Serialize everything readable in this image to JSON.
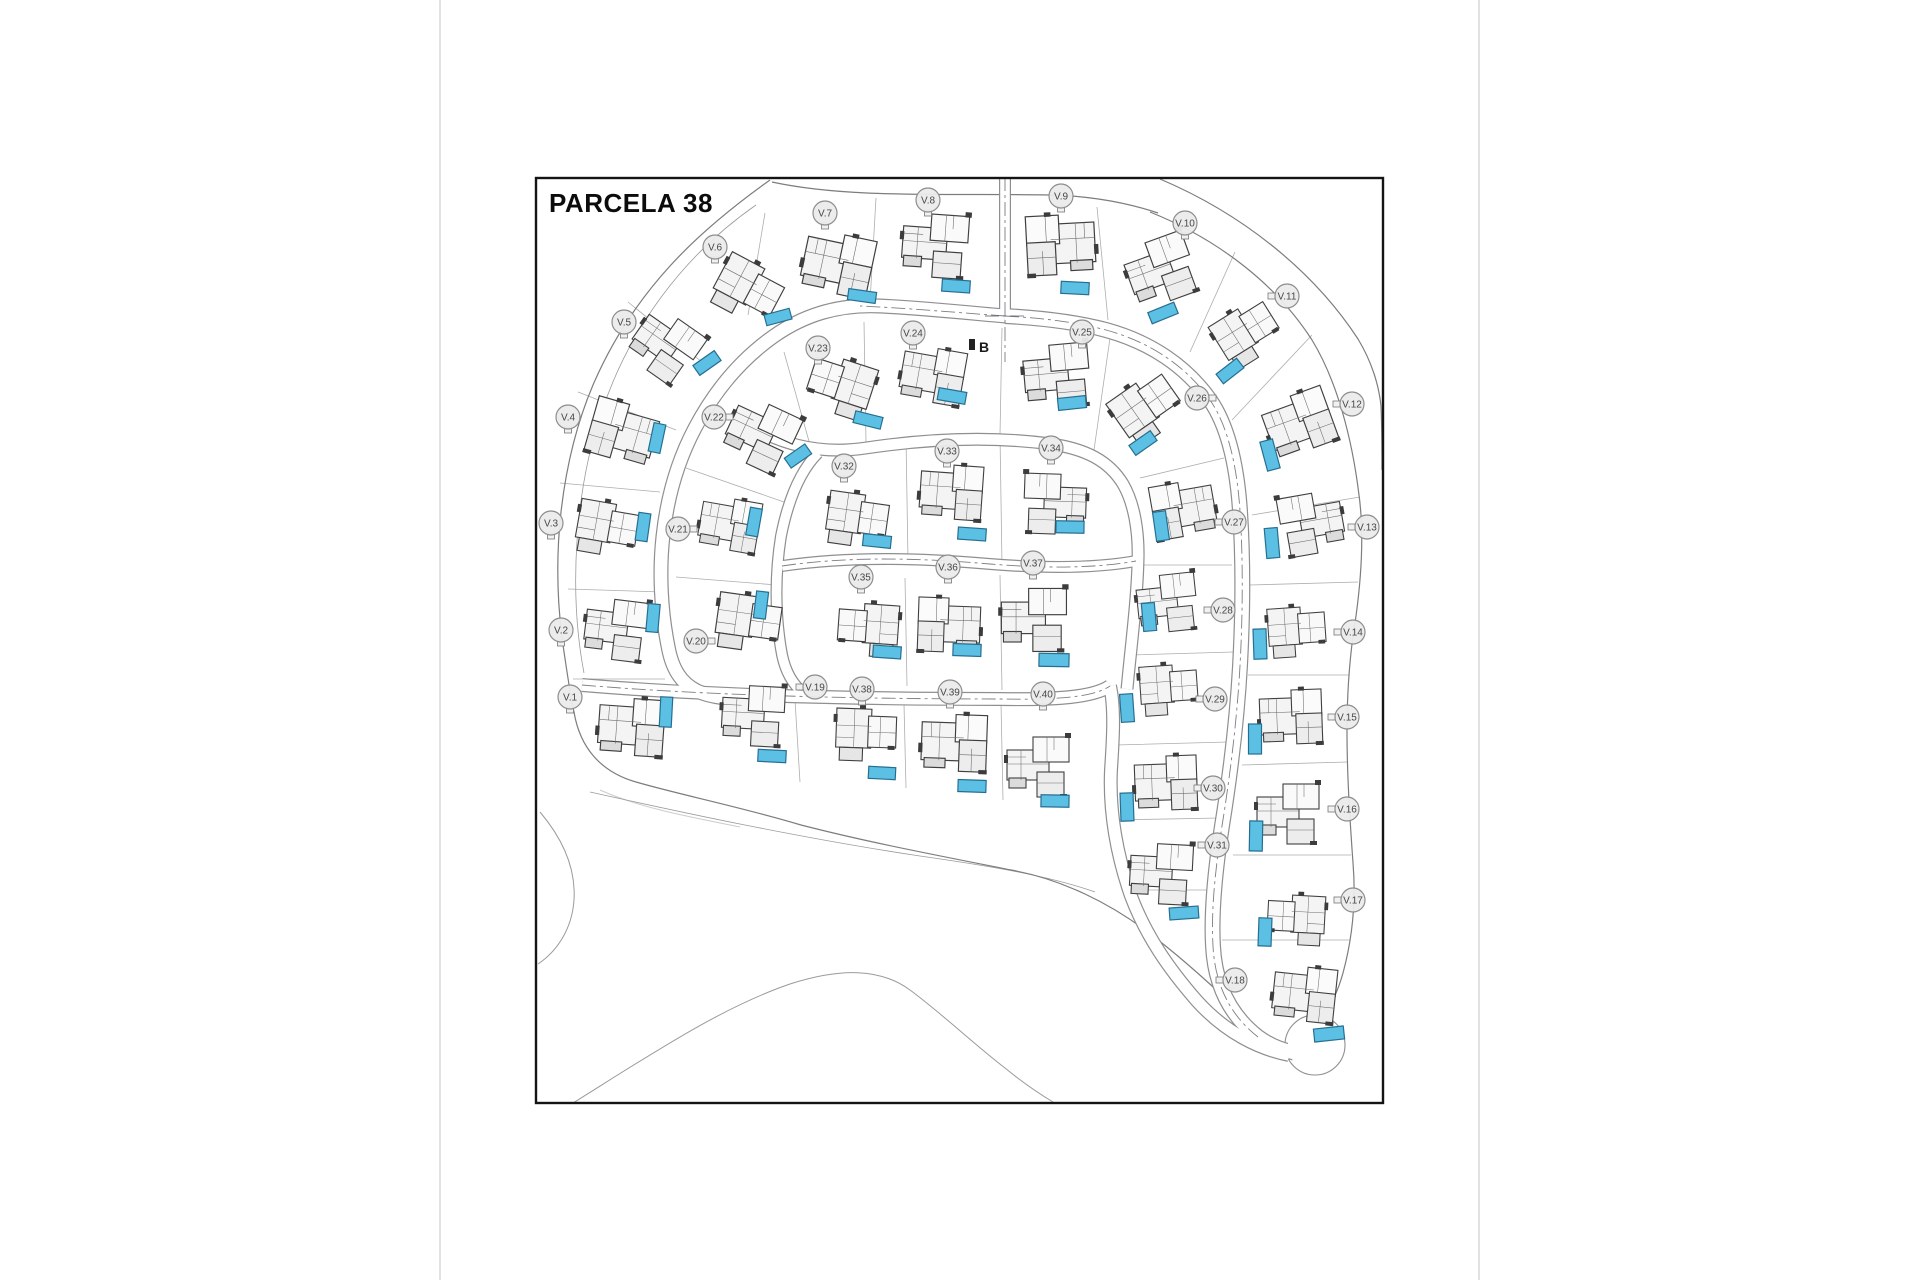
{
  "page": {
    "title": "PARCELA 38",
    "section_marker": "B"
  },
  "plan": {
    "colors": {
      "pool_fill": "#5bc0e4",
      "pool_stroke": "#266f91",
      "road_edge": "#8f8f8f",
      "label_fill": "#ebebeb",
      "label_stroke": "#8d8d8d",
      "label_text": "#474747"
    },
    "villas": [
      {
        "id": "V.1",
        "label": "V.1",
        "lx": 570,
        "ly": 697,
        "sq": "b",
        "hx": 631,
        "hy": 730,
        "ha": 4,
        "hs": 1.05,
        "variant": 0,
        "flip": false,
        "pool": {
          "x": 666,
          "y": 712,
          "w": 12,
          "h": 30,
          "a": 3
        }
      },
      {
        "id": "V.2",
        "label": "V.2",
        "lx": 561,
        "ly": 630,
        "sq": "b",
        "hx": 618,
        "hy": 631,
        "ha": 7,
        "hs": 1.0,
        "variant": 1,
        "flip": false,
        "pool": {
          "x": 653,
          "y": 618,
          "w": 12,
          "h": 28,
          "a": 5
        }
      },
      {
        "id": "V.3",
        "label": "V.3",
        "lx": 551,
        "ly": 523,
        "sq": "b",
        "hx": 606,
        "hy": 530,
        "ha": 10,
        "hs": 1.0,
        "variant": 2,
        "flip": false,
        "pool": {
          "x": 643,
          "y": 527,
          "w": 12,
          "h": 28,
          "a": 8
        }
      },
      {
        "id": "V.4",
        "label": "V.4",
        "lx": 568,
        "ly": 417,
        "sq": "b",
        "hx": 622,
        "hy": 435,
        "ha": 16,
        "hs": 1.05,
        "variant": 0,
        "flip": true,
        "pool": {
          "x": 657,
          "y": 438,
          "w": 12,
          "h": 29,
          "a": 12
        }
      },
      {
        "id": "V.5",
        "label": "V.5",
        "lx": 624,
        "ly": 322,
        "sq": "b",
        "hx": 666,
        "hy": 348,
        "ha": 35,
        "hs": 1.0,
        "variant": 1,
        "flip": false,
        "pool": {
          "x": 707,
          "y": 363,
          "w": 26,
          "h": 12,
          "a": -35
        }
      },
      {
        "id": "V.6",
        "label": "V.6",
        "lx": 715,
        "ly": 247,
        "sq": "b",
        "hx": 746,
        "hy": 291,
        "ha": 28,
        "hs": 1.05,
        "variant": 2,
        "flip": false,
        "pool": {
          "x": 778,
          "y": 317,
          "w": 26,
          "h": 11,
          "a": -15
        }
      },
      {
        "id": "V.7",
        "label": "V.7",
        "lx": 825,
        "ly": 213,
        "sq": "b",
        "hx": 837,
        "hy": 267,
        "ha": 12,
        "hs": 1.1,
        "variant": 0,
        "flip": false,
        "pool": {
          "x": 862,
          "y": 296,
          "w": 28,
          "h": 11,
          "a": 8
        }
      },
      {
        "id": "V.8",
        "label": "V.8",
        "lx": 928,
        "ly": 200,
        "sq": "b",
        "hx": 937,
        "hy": 247,
        "ha": 4,
        "hs": 1.05,
        "variant": 1,
        "flip": false,
        "pool": {
          "x": 956,
          "y": 286,
          "w": 28,
          "h": 12,
          "a": 4
        }
      },
      {
        "id": "V.9",
        "label": "V.9",
        "lx": 1061,
        "ly": 196,
        "sq": "b",
        "hx": 1061,
        "hy": 248,
        "ha": -3,
        "hs": 1.1,
        "variant": 0,
        "flip": true,
        "pool": {
          "x": 1075,
          "y": 288,
          "w": 28,
          "h": 12,
          "a": 3
        }
      },
      {
        "id": "V.10",
        "label": "V.10",
        "lx": 1185,
        "ly": 223,
        "sq": "b",
        "hx": 1163,
        "hy": 271,
        "ha": -20,
        "hs": 1.05,
        "variant": 1,
        "flip": false,
        "pool": {
          "x": 1163,
          "y": 313,
          "w": 28,
          "h": 12,
          "a": -22
        }
      },
      {
        "id": "V.11",
        "label": "V.11",
        "lx": 1287,
        "ly": 296,
        "sq": "l",
        "hx": 1247,
        "hy": 335,
        "ha": -32,
        "hs": 1.0,
        "variant": 2,
        "flip": false,
        "pool": {
          "x": 1230,
          "y": 371,
          "w": 26,
          "h": 12,
          "a": -38
        }
      },
      {
        "id": "V.12",
        "label": "V.12",
        "lx": 1352,
        "ly": 404,
        "sq": "l",
        "hx": 1300,
        "hy": 426,
        "ha": -20,
        "hs": 1.05,
        "variant": 0,
        "flip": false,
        "pool": {
          "x": 1270,
          "y": 455,
          "w": 13,
          "h": 30,
          "a": -15
        }
      },
      {
        "id": "V.13",
        "label": "V.13",
        "lx": 1367,
        "ly": 527,
        "sq": "l",
        "hx": 1310,
        "hy": 525,
        "ha": -10,
        "hs": 1.0,
        "variant": 1,
        "flip": true,
        "pool": {
          "x": 1272,
          "y": 543,
          "w": 13,
          "h": 30,
          "a": -5
        }
      },
      {
        "id": "V.14",
        "label": "V.14",
        "lx": 1353,
        "ly": 632,
        "sq": "l",
        "hx": 1296,
        "hy": 633,
        "ha": -4,
        "hs": 0.95,
        "variant": 2,
        "flip": false,
        "pool": {
          "x": 1260,
          "y": 644,
          "w": 13,
          "h": 30,
          "a": -2
        }
      },
      {
        "id": "V.15",
        "label": "V.15",
        "lx": 1347,
        "ly": 717,
        "sq": "l",
        "hx": 1291,
        "hy": 720,
        "ha": -2,
        "hs": 1.0,
        "variant": 0,
        "flip": false,
        "pool": {
          "x": 1255,
          "y": 739,
          "w": 13,
          "h": 30,
          "a": 0
        }
      },
      {
        "id": "V.16",
        "label": "V.16",
        "lx": 1347,
        "ly": 809,
        "sq": "l",
        "hx": 1290,
        "hy": 815,
        "ha": 0,
        "hs": 1.0,
        "variant": 1,
        "flip": false,
        "pool": {
          "x": 1256,
          "y": 836,
          "w": 13,
          "h": 30,
          "a": 1
        }
      },
      {
        "id": "V.17",
        "label": "V.17",
        "lx": 1353,
        "ly": 900,
        "sq": "l",
        "hx": 1297,
        "hy": 921,
        "ha": 3,
        "hs": 0.95,
        "variant": 2,
        "flip": true,
        "pool": {
          "x": 1265,
          "y": 932,
          "w": 13,
          "h": 28,
          "a": 2
        }
      },
      {
        "id": "V.18",
        "label": "V.18",
        "lx": 1235,
        "ly": 980,
        "sq": "l",
        "hx": 1304,
        "hy": 997,
        "ha": 6,
        "hs": 1.0,
        "variant": 0,
        "flip": false,
        "pool": {
          "x": 1329,
          "y": 1034,
          "w": 30,
          "h": 13,
          "a": -6
        }
      },
      {
        "id": "V.19",
        "label": "V.19",
        "lx": 815,
        "ly": 687,
        "sq": "l",
        "hx": 755,
        "hy": 717,
        "ha": 3,
        "hs": 1.0,
        "variant": 1,
        "flip": false,
        "pool": {
          "x": 772,
          "y": 756,
          "w": 28,
          "h": 12,
          "a": 3
        }
      },
      {
        "id": "V.20",
        "label": "V.20",
        "lx": 696,
        "ly": 641,
        "sq": "r",
        "hx": 747,
        "hy": 624,
        "ha": 8,
        "hs": 1.05,
        "variant": 2,
        "flip": false,
        "pool": {
          "x": 761,
          "y": 605,
          "w": 12,
          "h": 27,
          "a": 7
        }
      },
      {
        "id": "V.21",
        "label": "V.21",
        "lx": 678,
        "ly": 529,
        "sq": "r",
        "hx": 729,
        "hy": 527,
        "ha": 10,
        "hs": 0.95,
        "variant": 0,
        "flip": false,
        "pool": {
          "x": 754,
          "y": 522,
          "w": 12,
          "h": 28,
          "a": 10
        }
      },
      {
        "id": "V.22",
        "label": "V.22",
        "lx": 714,
        "ly": 417,
        "sq": "r",
        "hx": 762,
        "hy": 437,
        "ha": 25,
        "hs": 1.05,
        "variant": 1,
        "flip": false,
        "pool": {
          "x": 798,
          "y": 456,
          "w": 25,
          "h": 12,
          "a": -35
        }
      },
      {
        "id": "V.23",
        "label": "V.23",
        "lx": 818,
        "ly": 348,
        "sq": "b",
        "hx": 841,
        "hy": 388,
        "ha": 18,
        "hs": 1.05,
        "variant": 2,
        "flip": true,
        "pool": {
          "x": 868,
          "y": 420,
          "w": 28,
          "h": 12,
          "a": 14
        }
      },
      {
        "id": "V.24",
        "label": "V.24",
        "lx": 913,
        "ly": 333,
        "sq": "b",
        "hx": 932,
        "hy": 378,
        "ha": 10,
        "hs": 1.0,
        "variant": 0,
        "flip": false,
        "pool": {
          "x": 952,
          "y": 396,
          "w": 28,
          "h": 12,
          "a": 10
        }
      },
      {
        "id": "V.25",
        "label": "V.25",
        "lx": 1082,
        "ly": 332,
        "sq": "b",
        "hx": 1059,
        "hy": 377,
        "ha": -5,
        "hs": 1.05,
        "variant": 1,
        "flip": false,
        "pool": {
          "x": 1072,
          "y": 403,
          "w": 28,
          "h": 12,
          "a": -6
        }
      },
      {
        "id": "V.26",
        "label": "V.26",
        "lx": 1197,
        "ly": 398,
        "sq": "r",
        "hx": 1147,
        "hy": 410,
        "ha": -35,
        "hs": 1.05,
        "variant": 2,
        "flip": false,
        "pool": {
          "x": 1143,
          "y": 443,
          "w": 26,
          "h": 12,
          "a": -35
        }
      },
      {
        "id": "V.27",
        "label": "V.27",
        "lx": 1234,
        "ly": 522,
        "sq": "l",
        "hx": 1184,
        "hy": 512,
        "ha": -10,
        "hs": 1.0,
        "variant": 0,
        "flip": true,
        "pool": {
          "x": 1161,
          "y": 526,
          "w": 13,
          "h": 29,
          "a": -8
        }
      },
      {
        "id": "V.28",
        "label": "V.28",
        "lx": 1223,
        "ly": 610,
        "sq": "l",
        "hx": 1169,
        "hy": 604,
        "ha": -6,
        "hs": 0.95,
        "variant": 1,
        "flip": false,
        "pool": {
          "x": 1149,
          "y": 617,
          "w": 13,
          "h": 28,
          "a": -5
        }
      },
      {
        "id": "V.29",
        "label": "V.29",
        "lx": 1215,
        "ly": 699,
        "sq": "l",
        "hx": 1168,
        "hy": 691,
        "ha": -4,
        "hs": 0.95,
        "variant": 2,
        "flip": false,
        "pool": {
          "x": 1127,
          "y": 708,
          "w": 13,
          "h": 28,
          "a": -4
        }
      },
      {
        "id": "V.30",
        "label": "V.30",
        "lx": 1213,
        "ly": 788,
        "sq": "l",
        "hx": 1166,
        "hy": 786,
        "ha": -2,
        "hs": 1.0,
        "variant": 0,
        "flip": false,
        "pool": {
          "x": 1127,
          "y": 807,
          "w": 13,
          "h": 28,
          "a": -2
        }
      },
      {
        "id": "V.31",
        "label": "V.31",
        "lx": 1217,
        "ly": 845,
        "sq": "l",
        "hx": 1163,
        "hy": 875,
        "ha": 3,
        "hs": 1.0,
        "variant": 1,
        "flip": false,
        "pool": {
          "x": 1184,
          "y": 913,
          "w": 29,
          "h": 12,
          "a": -4
        }
      },
      {
        "id": "V.32",
        "label": "V.32",
        "lx": 844,
        "ly": 466,
        "sq": "b",
        "hx": 856,
        "hy": 521,
        "ha": 8,
        "hs": 1.0,
        "variant": 2,
        "flip": false,
        "pool": {
          "x": 877,
          "y": 541,
          "w": 28,
          "h": 12,
          "a": 6
        }
      },
      {
        "id": "V.33",
        "label": "V.33",
        "lx": 947,
        "ly": 451,
        "sq": "b",
        "hx": 951,
        "hy": 495,
        "ha": 4,
        "hs": 1.0,
        "variant": 0,
        "flip": false,
        "pool": {
          "x": 972,
          "y": 534,
          "w": 28,
          "h": 12,
          "a": 4
        }
      },
      {
        "id": "V.34",
        "label": "V.34",
        "lx": 1051,
        "ly": 448,
        "sq": "b",
        "hx": 1053,
        "hy": 505,
        "ha": 2,
        "hs": 1.0,
        "variant": 1,
        "flip": true,
        "pool": {
          "x": 1070,
          "y": 527,
          "w": 28,
          "h": 12,
          "a": 1
        }
      },
      {
        "id": "V.35",
        "label": "V.35",
        "lx": 861,
        "ly": 577,
        "sq": "b",
        "hx": 869,
        "hy": 631,
        "ha": 4,
        "hs": 1.0,
        "variant": 2,
        "flip": true,
        "pool": {
          "x": 887,
          "y": 652,
          "w": 28,
          "h": 12,
          "a": 4
        }
      },
      {
        "id": "V.36",
        "label": "V.36",
        "lx": 948,
        "ly": 567,
        "sq": "b",
        "hx": 949,
        "hy": 628,
        "ha": 2,
        "hs": 1.0,
        "variant": 0,
        "flip": true,
        "pool": {
          "x": 967,
          "y": 650,
          "w": 28,
          "h": 12,
          "a": 2
        }
      },
      {
        "id": "V.37",
        "label": "V.37",
        "lx": 1033,
        "ly": 563,
        "sq": "b",
        "hx": 1036,
        "hy": 621,
        "ha": 0,
        "hs": 1.05,
        "variant": 1,
        "flip": false,
        "pool": {
          "x": 1054,
          "y": 660,
          "w": 30,
          "h": 13,
          "a": 1
        }
      },
      {
        "id": "V.38",
        "label": "V.38",
        "lx": 862,
        "ly": 689,
        "sq": "b",
        "hx": 865,
        "hy": 736,
        "ha": 2,
        "hs": 1.0,
        "variant": 2,
        "flip": false,
        "pool": {
          "x": 882,
          "y": 773,
          "w": 27,
          "h": 12,
          "a": 3
        }
      },
      {
        "id": "V.39",
        "label": "V.39",
        "lx": 950,
        "ly": 692,
        "sq": "b",
        "hx": 954,
        "hy": 746,
        "ha": 2,
        "hs": 1.05,
        "variant": 0,
        "flip": false,
        "pool": {
          "x": 972,
          "y": 786,
          "w": 28,
          "h": 12,
          "a": 2
        }
      },
      {
        "id": "V.40",
        "label": "V.40",
        "lx": 1043,
        "ly": 694,
        "sq": "b",
        "hx": 1040,
        "hy": 768,
        "ha": 0,
        "hs": 1.0,
        "variant": 1,
        "flip": false,
        "pool": {
          "x": 1055,
          "y": 801,
          "w": 28,
          "h": 12,
          "a": 1
        }
      }
    ]
  }
}
